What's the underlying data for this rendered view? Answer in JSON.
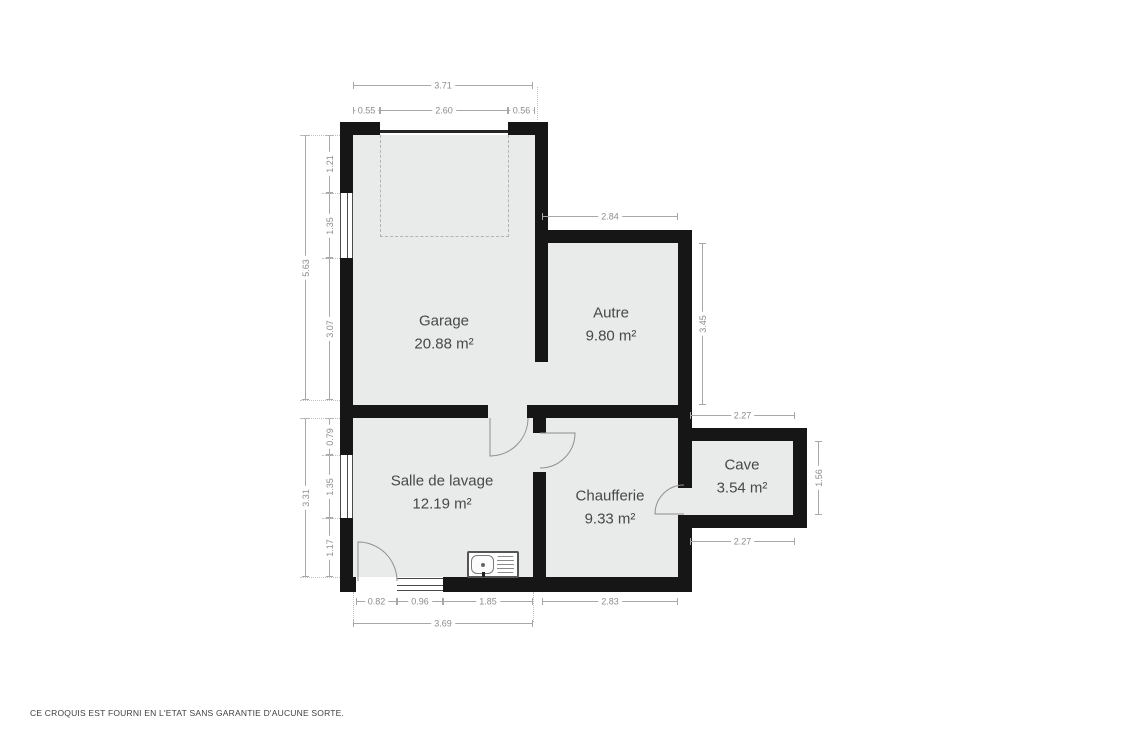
{
  "plan": {
    "disclaimer": "CE CROQUIS EST FOURNI EN L'ETAT SANS GARANTIE D'AUCUNE SORTE.",
    "unit": "m²"
  },
  "colors": {
    "wall": "#161616",
    "room_fill": "#e9eaea",
    "dimension_line": "#a8a8a8",
    "dimension_text": "#8c8c8c",
    "label_text": "#484848",
    "door_arc": "#8f8f8f",
    "background": "#ffffff"
  },
  "rooms": [
    {
      "name": "Garage",
      "area": "20.88 m²"
    },
    {
      "name": "Autre",
      "area": "9.80 m²"
    },
    {
      "name": "Salle de lavage",
      "area": "12.19 m²"
    },
    {
      "name": "Chaufferie",
      "area": "9.33 m²"
    },
    {
      "name": "Cave",
      "area": "3.54 m²"
    }
  ],
  "dimensions": {
    "top_total": "3.71",
    "top_left": "0.55",
    "top_mid": "2.60",
    "top_right": "0.56",
    "left_upper_total": "5.63",
    "left_upper_a": "1.21",
    "left_upper_b": "1.35",
    "left_upper_c": "3.07",
    "left_lower_total": "3.31",
    "left_lower_a": "0.79",
    "left_lower_b": "1.35",
    "left_lower_c": "1.17",
    "autre_top": "2.84",
    "autre_right": "3.45",
    "cave_top": "2.27",
    "cave_right": "1.56",
    "cave_bottom": "2.27",
    "bottom_a": "0.82",
    "bottom_b": "0.96",
    "bottom_c": "1.85",
    "bottom_d": "2.83",
    "bottom_total": "3.69"
  }
}
